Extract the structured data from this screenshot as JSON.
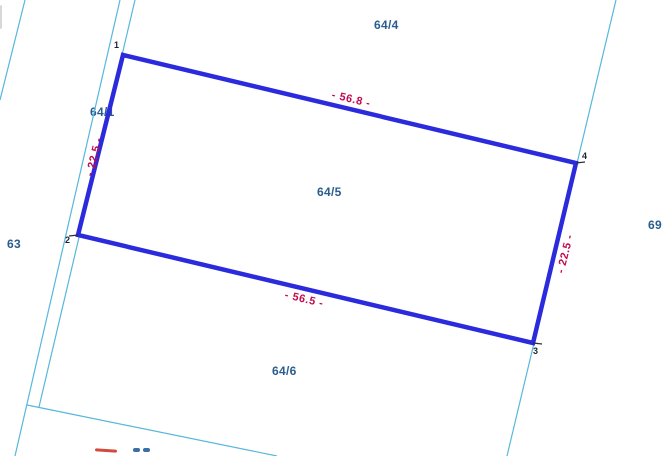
{
  "map": {
    "description": "cadastral-parcel-map-view",
    "background": "#ffffff"
  },
  "colors": {
    "parcel_outline": "#2b2bdd",
    "boundary_line": "#56b8dc",
    "dimension_text": "#c4094d",
    "parcel_label_text": "#2a5d8e",
    "point_label_text": "#1b2430",
    "corner_tick": "#2f2f3a"
  },
  "selected_parcel": {
    "id": "64/5",
    "corners": [
      [
        123,
        55
      ],
      [
        576,
        163
      ],
      [
        533,
        343
      ],
      [
        78,
        235
      ]
    ],
    "outline_width": 4.5
  },
  "parcel_labels": [
    {
      "text": "64/4",
      "x": 374,
      "y": 19
    },
    {
      "text": "64/5",
      "x": 317,
      "y": 186
    },
    {
      "text": "64/6",
      "x": 272,
      "y": 365
    },
    {
      "text": "64/1",
      "x": 90,
      "y": 106
    },
    {
      "text": "63",
      "x": 7,
      "y": 238
    },
    {
      "text": "69",
      "x": 648,
      "y": 219
    }
  ],
  "point_labels": [
    {
      "text": "1",
      "x": 114,
      "y": 41
    },
    {
      "text": "2",
      "x": 65,
      "y": 236
    },
    {
      "text": "3",
      "x": 533,
      "y": 347
    },
    {
      "text": "4",
      "x": 582,
      "y": 152
    }
  ],
  "dimension_labels": [
    {
      "text": "- 56.8 -",
      "cx": 351,
      "cy": 100,
      "rotate": 13.4
    },
    {
      "text": "- 56.5 -",
      "cx": 304,
      "cy": 300,
      "rotate": 13.4
    },
    {
      "text": "- 22.5 -",
      "cx": 95,
      "cy": 157,
      "rotate": -76
    },
    {
      "text": "- 22.5 -",
      "cx": 566,
      "cy": 254,
      "rotate": -76
    }
  ],
  "boundary_lines": [
    {
      "name": "west-boundary-line",
      "x1": 25,
      "y1": 0,
      "x2": 0,
      "y2": 100
    },
    {
      "name": "strip-left-line",
      "x1": 120,
      "y1": 0,
      "x2": 15,
      "y2": 456
    },
    {
      "name": "strip-right-line",
      "x1": 135,
      "y1": 0,
      "x2": 39,
      "y2": 407
    },
    {
      "name": "south-branch-line",
      "x1": 27,
      "y1": 405,
      "x2": 277,
      "y2": 456
    },
    {
      "name": "east-boundary-line",
      "x1": 616,
      "y1": 0,
      "x2": 507,
      "y2": 456
    }
  ],
  "corner_ticks": [
    {
      "x1": 78,
      "y1": 235,
      "x2": 69,
      "y2": 236
    },
    {
      "x1": 533,
      "y1": 343,
      "x2": 542,
      "y2": 344
    },
    {
      "x1": 576,
      "y1": 163,
      "x2": 585,
      "y2": 162
    }
  ],
  "edge_fragments": [
    {
      "name": "bottom-red-text-fragment",
      "x": 95,
      "y": 449,
      "w": 22,
      "h": 3,
      "rotate": 4,
      "color": "#d04b3e"
    },
    {
      "name": "bottom-blue-text-fragment-a",
      "x": 133,
      "y": 448,
      "w": 7,
      "h": 3.5,
      "rotate": 0,
      "color": "#3a6ea8"
    },
    {
      "name": "bottom-blue-text-fragment-b",
      "x": 143,
      "y": 448,
      "w": 7,
      "h": 3.5,
      "rotate": 0,
      "color": "#3a6ea8"
    },
    {
      "name": "left-gray-sliver",
      "x": 0,
      "y": 5,
      "w": 2,
      "h": 24,
      "rotate": 0,
      "color": "#d8d8d8"
    }
  ]
}
